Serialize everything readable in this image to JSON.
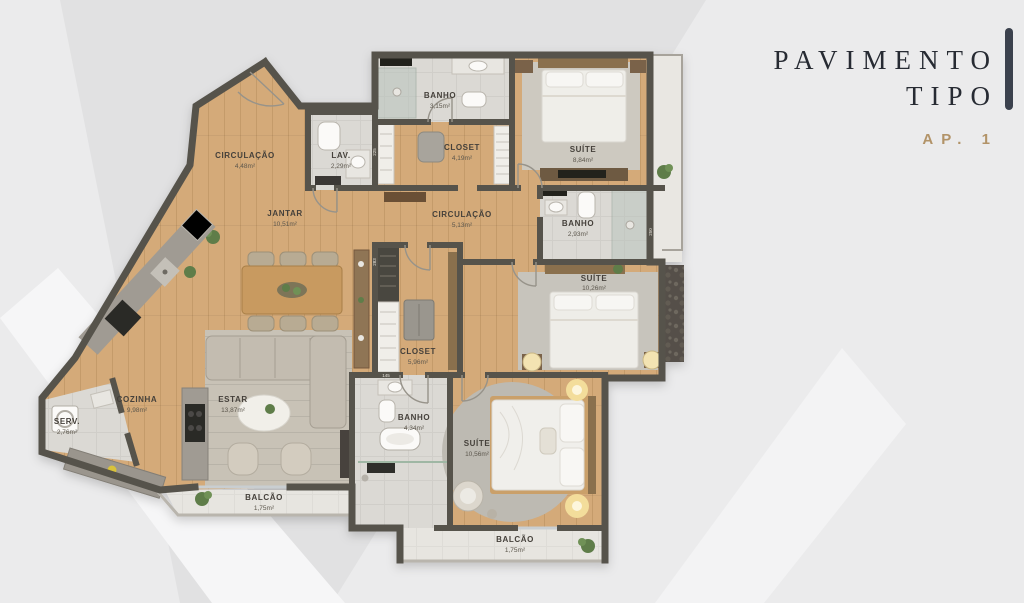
{
  "header": {
    "line1": "PAVIMENTO",
    "line2": "TIPO",
    "apartment": "AP. 1"
  },
  "floorplan": {
    "rooms": [
      {
        "id": "circulacao-1",
        "name": "CIRCULAÇÃO",
        "area": "4,48m²"
      },
      {
        "id": "lav",
        "name": "LAV.",
        "area": "2,29m²"
      },
      {
        "id": "banho-1",
        "name": "BANHO",
        "area": "3,15m²"
      },
      {
        "id": "closet-1",
        "name": "CLOSET",
        "area": "4,19m²"
      },
      {
        "id": "suite-1",
        "name": "SUÍTE",
        "area": "8,84m²"
      },
      {
        "id": "jantar",
        "name": "JANTAR",
        "area": "10,51m²"
      },
      {
        "id": "circulacao-2",
        "name": "CIRCULAÇÃO",
        "area": "5,13m²"
      },
      {
        "id": "banho-2",
        "name": "BANHO",
        "area": "2,93m²"
      },
      {
        "id": "suite-2",
        "name": "SUÍTE",
        "area": "10,26m²"
      },
      {
        "id": "closet-2",
        "name": "CLOSET",
        "area": "5,96m²"
      },
      {
        "id": "banho-3",
        "name": "BANHO",
        "area": "4,34m²"
      },
      {
        "id": "suite-3",
        "name": "SUÍTE",
        "area": "10,56m²"
      },
      {
        "id": "cozinha",
        "name": "COZINHA",
        "area": "9,98m²"
      },
      {
        "id": "estar",
        "name": "ESTAR",
        "area": "13,87m²"
      },
      {
        "id": "serv",
        "name": "SERV.",
        "area": "2,76m²"
      },
      {
        "id": "balcao-1",
        "name": "BALCÃO",
        "area": "1,75m²"
      },
      {
        "id": "balcao-2",
        "name": "BALCÃO",
        "area": "1,75m²"
      }
    ],
    "dimensions": [
      "225",
      "283",
      "250",
      "145"
    ],
    "colors": {
      "wall": "#56534b",
      "wood_floor": "#d4aa79",
      "title_text": "#272b33",
      "accent_gold": "#b29368",
      "background": "#ebebec"
    }
  }
}
